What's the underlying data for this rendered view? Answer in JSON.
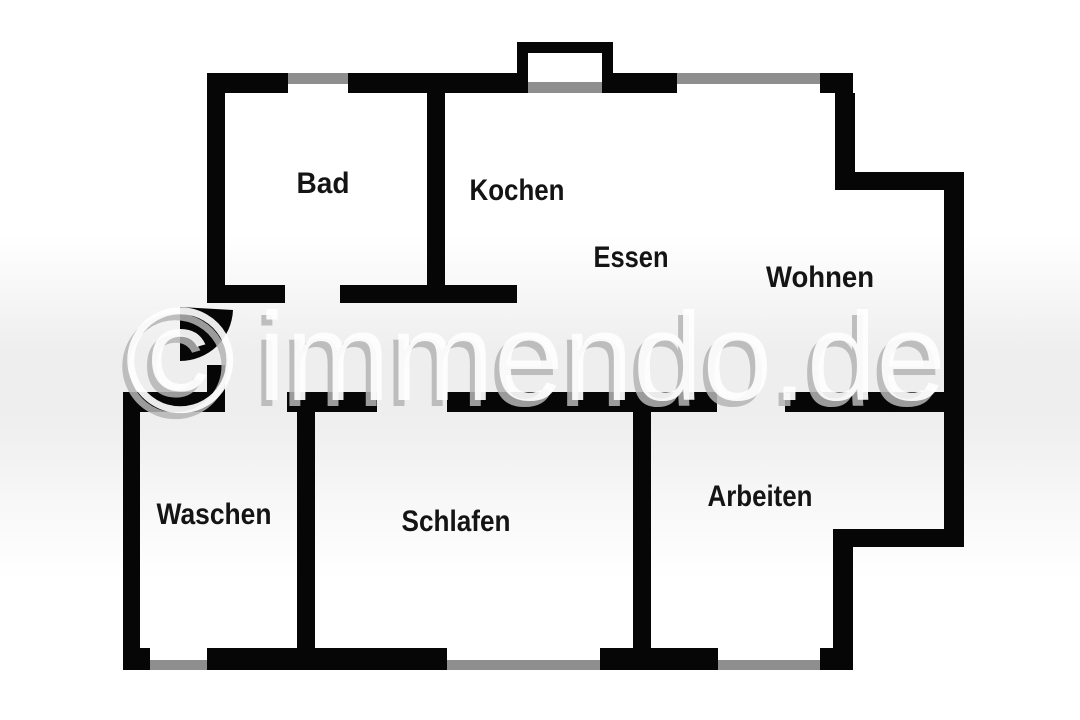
{
  "plan": {
    "width": 1080,
    "height": 720,
    "rooms": [
      {
        "id": "bad",
        "label": "Bad",
        "x": 323,
        "y": 193,
        "w": 53
      },
      {
        "id": "kochen",
        "label": "Kochen",
        "x": 517,
        "y": 200,
        "w": 95
      },
      {
        "id": "essen",
        "label": "Essen",
        "x": 631,
        "y": 267,
        "w": 75
      },
      {
        "id": "wohnen",
        "label": "Wohnen",
        "x": 820,
        "y": 287,
        "w": 108
      },
      {
        "id": "waschen",
        "label": "Waschen",
        "x": 214,
        "y": 524,
        "w": 115
      },
      {
        "id": "schlafen",
        "label": "Schlafen",
        "x": 456,
        "y": 531,
        "w": 109
      },
      {
        "id": "arbeiten",
        "label": "Arbeiten",
        "x": 760,
        "y": 506,
        "w": 105
      }
    ],
    "walls": [
      [
        207,
        73,
        81,
        20
      ],
      [
        348,
        73,
        169,
        20
      ],
      [
        613,
        73,
        64,
        20
      ],
      [
        820,
        73,
        33,
        20
      ],
      [
        517,
        42,
        96,
        11
      ],
      [
        517,
        42,
        11,
        51
      ],
      [
        602,
        42,
        11,
        51
      ],
      [
        835,
        93,
        20,
        97
      ],
      [
        835,
        172,
        129,
        18
      ],
      [
        944,
        190,
        20,
        357
      ],
      [
        833,
        529,
        131,
        18
      ],
      [
        833,
        547,
        20,
        121
      ],
      [
        820,
        648,
        33,
        22
      ],
      [
        600,
        648,
        118,
        22
      ],
      [
        207,
        648,
        240,
        22
      ],
      [
        140,
        648,
        10,
        22
      ],
      [
        123,
        392,
        17,
        278
      ],
      [
        123,
        392,
        102,
        20
      ],
      [
        207,
        365,
        18,
        47
      ],
      [
        207,
        73,
        18,
        230
      ],
      [
        207,
        285,
        78,
        18
      ],
      [
        340,
        285,
        177,
        18
      ],
      [
        427,
        93,
        18,
        200
      ],
      [
        287,
        392,
        90,
        20
      ],
      [
        447,
        392,
        270,
        20
      ],
      [
        785,
        392,
        159,
        20
      ],
      [
        297,
        410,
        18,
        260
      ],
      [
        633,
        410,
        18,
        240
      ]
    ],
    "windows": [
      [
        288,
        73,
        60,
        11
      ],
      [
        528,
        82,
        74,
        11
      ],
      [
        677,
        73,
        143,
        11
      ],
      [
        150,
        660,
        57,
        10
      ],
      [
        447,
        660,
        153,
        10
      ],
      [
        718,
        660,
        102,
        10
      ]
    ],
    "door_swing_path": "M 180 307 L 180 361 A 53 53 0 0 0 233 310 Z",
    "colors": {
      "wall": "#060606",
      "window": "#8e8e8e",
      "label": "#141414",
      "background": "#ffffff",
      "watermark_highlight": "#ffffff",
      "watermark_shadow": "#b5b5b5"
    }
  },
  "watermark": {
    "full_text": "© immendo.de",
    "copyright_symbol": "©",
    "name_text": "immendo.de"
  }
}
